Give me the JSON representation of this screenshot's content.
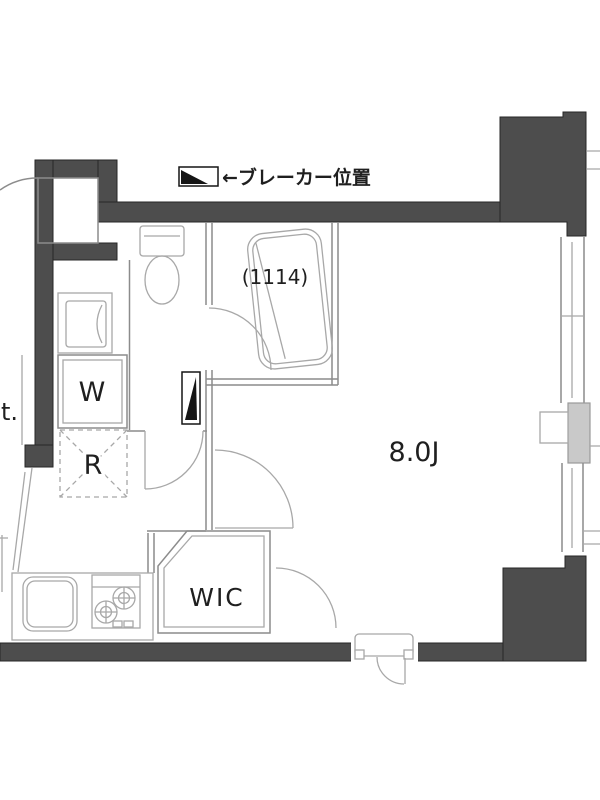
{
  "plan": {
    "title": "studio-floor-plan",
    "legend": {
      "breaker_label": "←ブレーカー位置"
    },
    "labels": {
      "bath_dimensions": "(1114)",
      "washer": "W",
      "refrigerator": "R",
      "main_room_size": "8.0J",
      "closet": "WIC",
      "left_edge_cutoff": "t."
    },
    "colors": {
      "wall": "#4d4d4d",
      "wall_outline": "#262626",
      "thin_line": "#8c8c8c",
      "fixture_line": "#a8a8a8",
      "marker": "#151515",
      "shaded_box": "#c9c9c9",
      "text": "#1f1f1f",
      "background": "#ffffff"
    }
  }
}
